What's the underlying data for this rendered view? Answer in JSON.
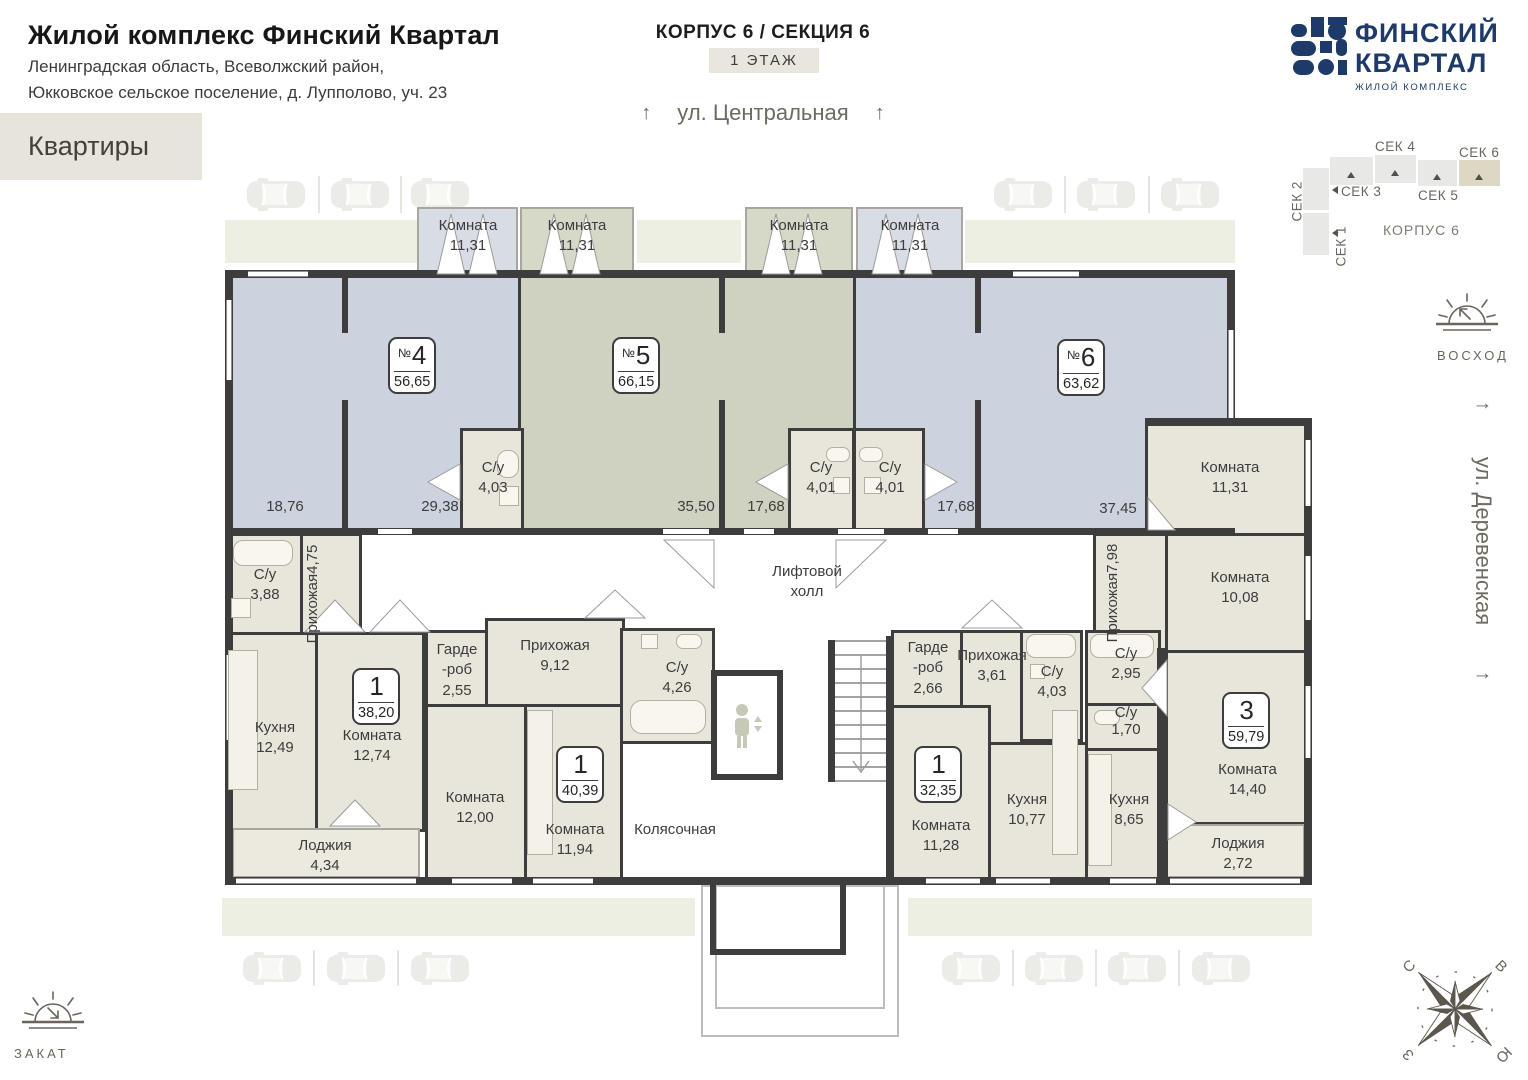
{
  "header": {
    "title": "Жилой комплекс Финский Квартал",
    "address_line1": "Ленинградская область, Всеволжский район,",
    "address_line2": "Юкковское сельское поселение, д. Лупполово, уч. 23",
    "page_label": "Квартиры",
    "building_label": "КОРПУС 6 / СЕКЦИЯ 6",
    "floor_label": "1 ЭТАЖ"
  },
  "logo": {
    "line1": "ФИНСКИЙ",
    "line2": "КВАРТАЛ",
    "tagline": "ЖИЛОЙ КОМПЛЕКС"
  },
  "streets": {
    "top": "ул. Центральная",
    "right": "ул. Деревенская",
    "arrow": "↑"
  },
  "section_map": {
    "labels": [
      "СЕК 1",
      "СЕК 2",
      "СЕК 3",
      "СЕК 4",
      "СЕК 5",
      "СЕК 6"
    ],
    "active": "СЕК 6",
    "korpus": "КОРПУС 6"
  },
  "sun": {
    "sunrise": "ВОСХОД",
    "sunset": "ЗАКАТ"
  },
  "compass": {
    "n": "С",
    "e": "В",
    "s": "Ю",
    "w": "З"
  },
  "apartments": [
    {
      "prefix": "№",
      "num": "4",
      "area": "56,65"
    },
    {
      "prefix": "№",
      "num": "5",
      "area": "66,15"
    },
    {
      "prefix": "№",
      "num": "6",
      "area": "63,62"
    },
    {
      "prefix": "",
      "num": "1",
      "area": "38,20"
    },
    {
      "prefix": "",
      "num": "1",
      "area": "40,39"
    },
    {
      "prefix": "",
      "num": "1",
      "area": "32,35"
    },
    {
      "prefix": "",
      "num": "3",
      "area": "59,79"
    }
  ],
  "zones": {
    "apt4": [
      "18,76",
      "29,38"
    ],
    "apt5": [
      "35,50",
      "17,68"
    ],
    "apt6": [
      "17,68",
      "37,45"
    ]
  },
  "rooms": [
    {
      "name": "Комната",
      "area": "11,31"
    },
    {
      "name": "Комната",
      "area": "11,31"
    },
    {
      "name": "Комната",
      "area": "11,31"
    },
    {
      "name": "Комната",
      "area": "11,31"
    },
    {
      "name": "С/у",
      "area": "4,03"
    },
    {
      "name": "С/у",
      "area": "4,01"
    },
    {
      "name": "С/у",
      "area": "4,01"
    },
    {
      "name": "Комната",
      "area": "11,31"
    },
    {
      "name": "Комната",
      "area": "10,08"
    },
    {
      "name": "Прихожая",
      "area": "7,98"
    },
    {
      "name": "Комната",
      "area": "14,40"
    },
    {
      "name": "Лоджия",
      "area": "2,72"
    },
    {
      "name": "С/у",
      "area": "3,88"
    },
    {
      "name": "Прихожая",
      "area": "4,75"
    },
    {
      "name": "Кухня",
      "area": "12,49"
    },
    {
      "name": "Комната",
      "area": "12,74"
    },
    {
      "name": "Лоджия",
      "area": "4,34"
    },
    {
      "name": "Гарде\n-роб",
      "area": "2,55"
    },
    {
      "name": "Прихожая",
      "area": "9,12"
    },
    {
      "name": "Комната",
      "area": "12,00"
    },
    {
      "name": "Комната",
      "area": "11,94"
    },
    {
      "name": "С/у",
      "area": "4,26"
    },
    {
      "name": "Гарде\n-роб",
      "area": "2,66"
    },
    {
      "name": "Прихожая",
      "area": "3,61"
    },
    {
      "name": "С/у",
      "area": "4,03"
    },
    {
      "name": "С/у",
      "area": "2,95"
    },
    {
      "name": "С/у",
      "area": "1,70"
    },
    {
      "name": "Комната",
      "area": "11,28"
    },
    {
      "name": "Кухня",
      "area": "10,77"
    },
    {
      "name": "Кухня",
      "area": "8,65"
    }
  ],
  "labels": {
    "lift": "Лифтовой\nхолл",
    "stroller": "Колясочная"
  },
  "colors": {
    "wall": "#3d3d3d",
    "apt_blue": "#ccd3df",
    "apt_olive": "#cfd2c0",
    "room_beige": "#e8e5da",
    "band_green": "#edefe3",
    "accent_beige": "#e9e6de",
    "logo_navy": "#1d3a69"
  }
}
